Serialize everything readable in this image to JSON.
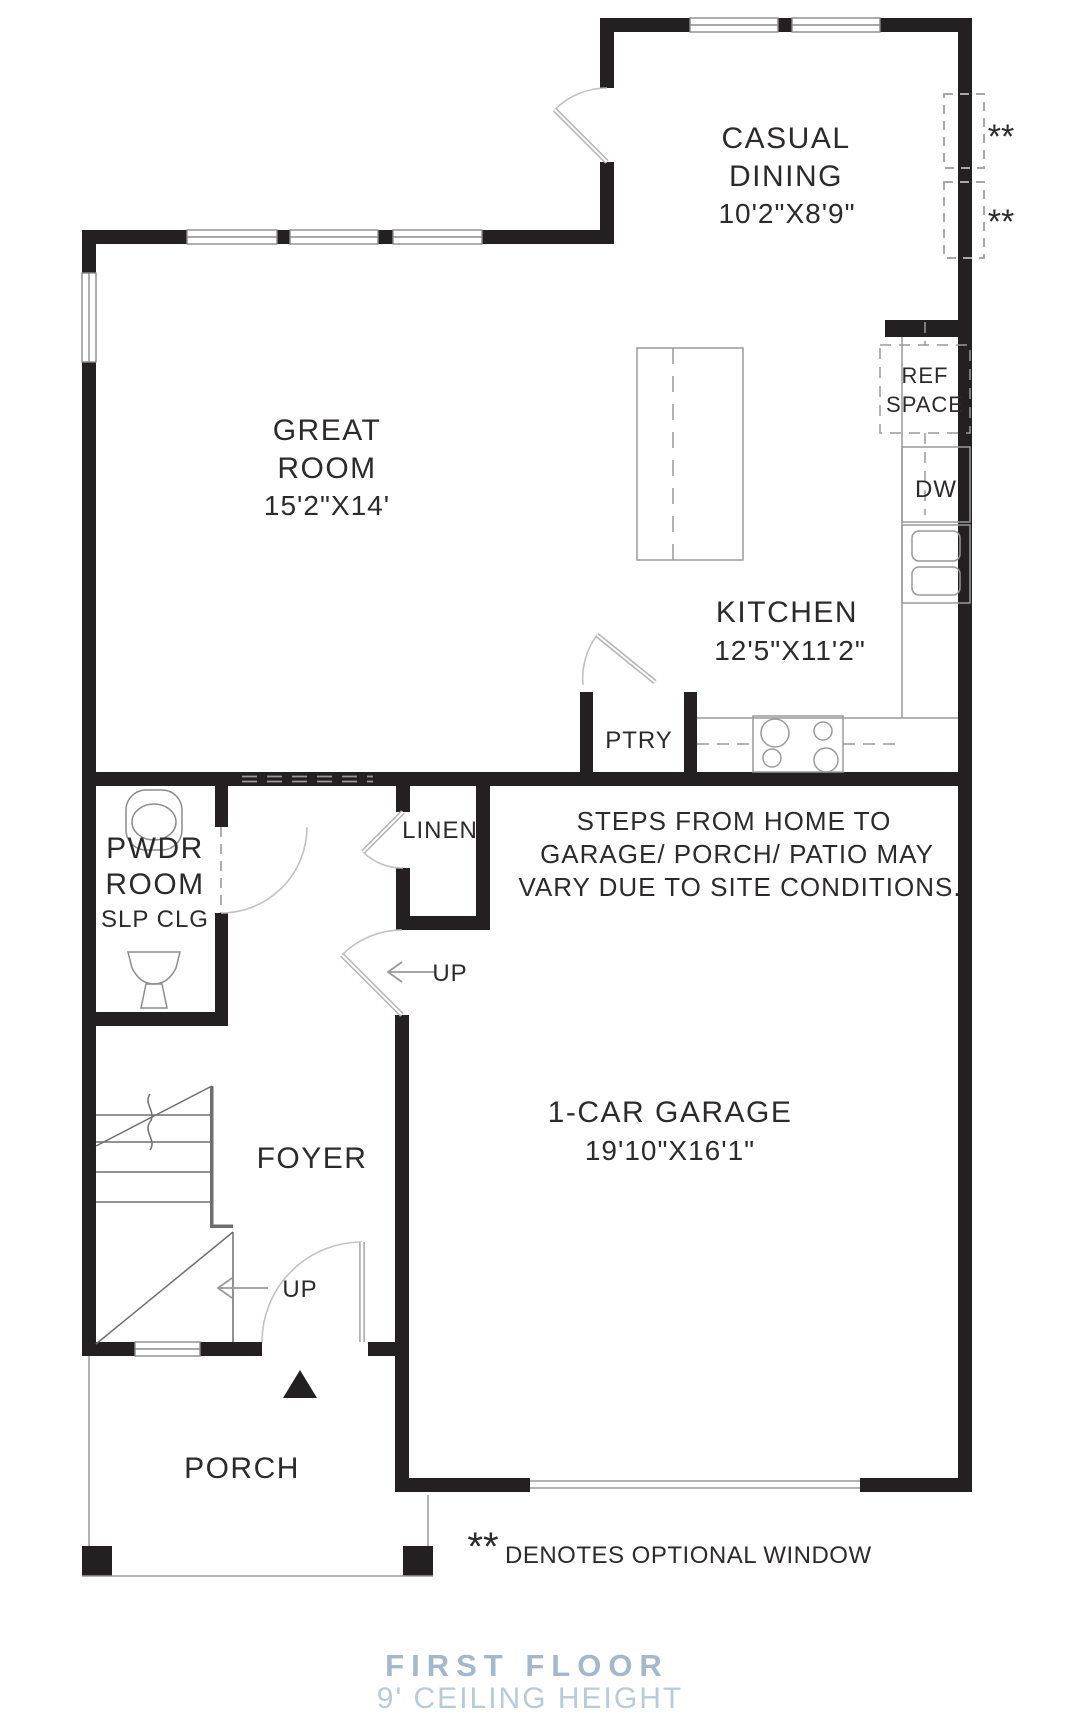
{
  "title": {
    "floor": "FIRST FLOOR",
    "ceiling": "9' CEILING HEIGHT"
  },
  "legend": {
    "symbol": "**",
    "text": "DENOTES OPTIONAL WINDOW"
  },
  "optional_window_markers": {
    "upper": "**",
    "lower": "**"
  },
  "rooms": {
    "casual_dining": {
      "line1": "CASUAL",
      "line2": "DINING",
      "dims": "10'2\"X8'9\""
    },
    "great_room": {
      "line1": "GREAT",
      "line2": "ROOM",
      "dims": "15'2\"X14'"
    },
    "kitchen": {
      "name": "KITCHEN",
      "dims": "12'5\"X11'2\""
    },
    "pantry": {
      "name": "PTRY"
    },
    "linen": {
      "name": "LINEN"
    },
    "powder_room": {
      "line1": "PWDR",
      "line2": "ROOM",
      "line3": "SLP CLG"
    },
    "foyer": {
      "name": "FOYER"
    },
    "garage": {
      "name": "1-CAR GARAGE",
      "dims": "19'10\"X16'1\""
    },
    "porch": {
      "name": "PORCH"
    }
  },
  "fixtures": {
    "ref_line1": "REF",
    "ref_line2": "SPACE",
    "dishwasher": "DW"
  },
  "stairs": {
    "up_garage": "UP",
    "up_foyer": "UP"
  },
  "note": {
    "line1": "STEPS FROM HOME TO",
    "line2": "GARAGE/ PORCH/ PATIO MAY",
    "line3": "VARY DUE TO SITE CONDITIONS."
  },
  "colors": {
    "wall": "#241f21",
    "thin_line": "#9a9a9a",
    "door_arc": "#b3b3b3",
    "stair_line": "#6e6e6e",
    "caption_title": "#a3b8ca",
    "caption_sub": "#b9cbd9"
  }
}
